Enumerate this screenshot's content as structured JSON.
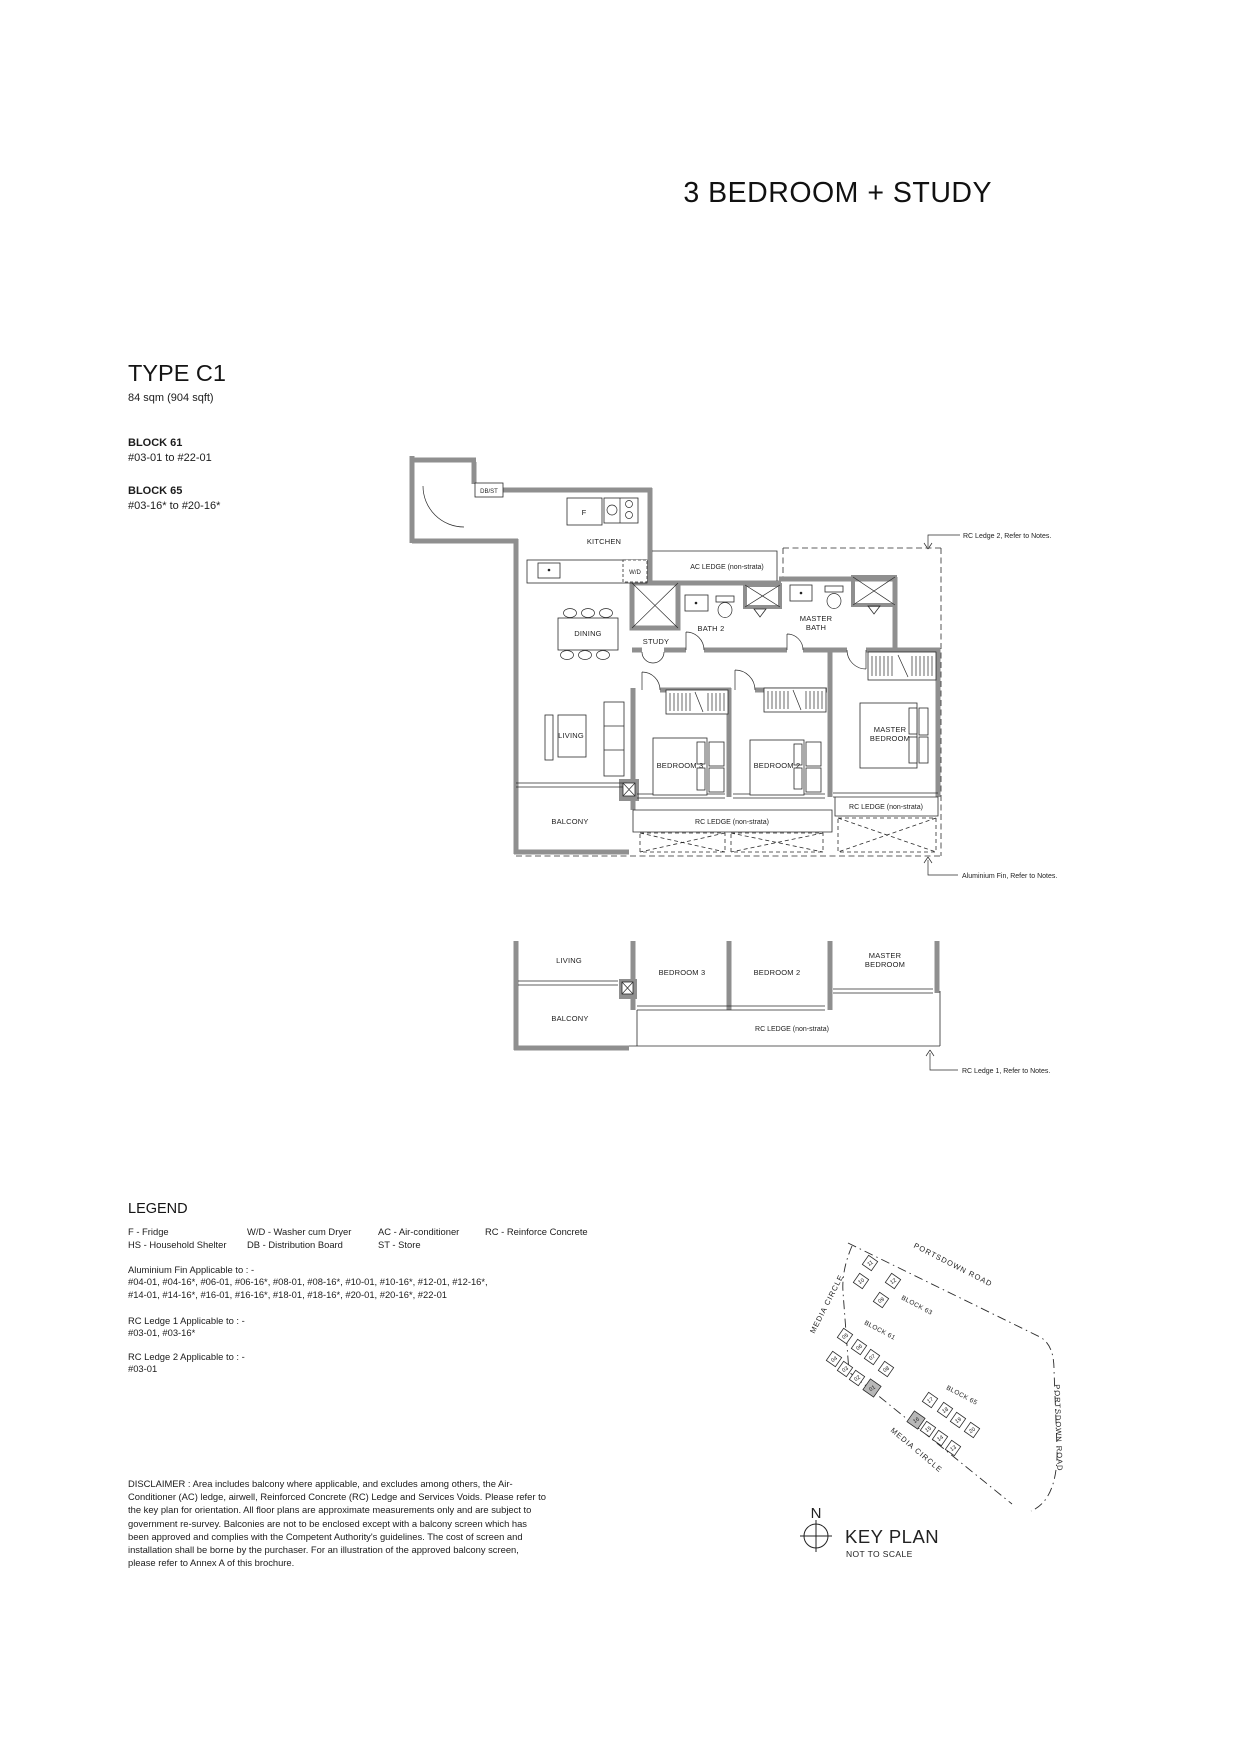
{
  "page": {
    "title": "3 BEDROOM + STUDY"
  },
  "unit": {
    "type": "TYPE C1",
    "area": "84 sqm (904 sqft)",
    "blocks": [
      {
        "name": "BLOCK 61",
        "range": "#03-01 to #22-01"
      },
      {
        "name": "BLOCK 65",
        "range": "#03-16* to #20-16*"
      }
    ]
  },
  "plan": {
    "entry_store": "DB/ST",
    "fridge": "F",
    "kitchen": "KITCHEN",
    "washer": "W/D",
    "ac_ledge": "AC LEDGE (non-strata)",
    "dining": "DINING",
    "study": "STUDY",
    "bath2": "BATH 2",
    "master_bath": [
      "MASTER",
      "BATH"
    ],
    "living": "LIVING",
    "bedroom3": "BEDROOM 3",
    "bedroom2": "BEDROOM 2",
    "master_bedroom": [
      "MASTER",
      "BEDROOM"
    ],
    "balcony": "BALCONY",
    "rc_ledge": "RC LEDGE (non-strata)",
    "annotations": {
      "rc_ledge_2": "RC Ledge 2, Refer to Notes.",
      "aluminium_fin": "Aluminium Fin, Refer to Notes.",
      "rc_ledge_1": "RC Ledge 1, Refer to Notes."
    }
  },
  "legend": {
    "heading": "LEGEND",
    "abbreviations": [
      "F - Fridge",
      "W/D - Washer cum Dryer",
      "AC - Air-conditioner",
      "RC - Reinforce Concrete",
      "HS - Household Shelter",
      "DB - Distribution Board",
      "ST - Store"
    ],
    "aluminium_fin": {
      "title": "Aluminium Fin Applicable to : -",
      "lines": [
        "#04-01, #04-16*, #06-01, #06-16*, #08-01, #08-16*, #10-01, #10-16*, #12-01, #12-16*,",
        "#14-01, #14-16*, #16-01, #16-16*, #18-01, #18-16*, #20-01, #20-16*, #22-01"
      ]
    },
    "rc_ledge_1": {
      "title": "RC Ledge 1 Applicable to : -",
      "lines": [
        "#03-01, #03-16*"
      ]
    },
    "rc_ledge_2": {
      "title": "RC Ledge 2 Applicable to : -",
      "lines": [
        "#03-01"
      ]
    }
  },
  "disclaimer": "DISCLAIMER : Area includes balcony where applicable, and excludes among others, the Air-Conditioner (AC) ledge, airwell, Reinforced Concrete (RC) Ledge and Services Voids. Please refer to the key plan for orientation. All floor plans are approximate measurements only and are subject to government re-survey. Balconies are not to be enclosed except with a balcony screen which has been approved and complies with the Competent Authority's guidelines. The cost of screen and installation shall be borne by the purchaser. For an illustration of the approved balcony screen, please refer to Annex A of this brochure.",
  "keyplan": {
    "title": "KEY PLAN",
    "subtitle": "NOT TO SCALE",
    "north": "N",
    "roads": {
      "portsdown_top": "PORTSDOWN ROAD",
      "portsdown_right": "PORTSDOWN ROAD",
      "media_circle_left": "MEDIA CIRCLE",
      "media_circle_bottom": "MEDIA CIRCLE"
    },
    "blocks": [
      {
        "label": "BLOCK 63",
        "units": [
          "11",
          "10",
          "12",
          "09"
        ]
      },
      {
        "label": "BLOCK 61",
        "units": [
          "05",
          "06",
          "07",
          "08",
          "04",
          "03",
          "02",
          "01"
        ],
        "highlighted": "01"
      },
      {
        "label": "BLOCK 65",
        "units": [
          "17",
          "18",
          "19",
          "20",
          "16",
          "15",
          "14",
          "13"
        ],
        "highlighted": "16"
      }
    ]
  },
  "colors": {
    "wall": "#8f8f8f",
    "line": "#2b2b2b",
    "highlight": "#b8b8b8"
  }
}
